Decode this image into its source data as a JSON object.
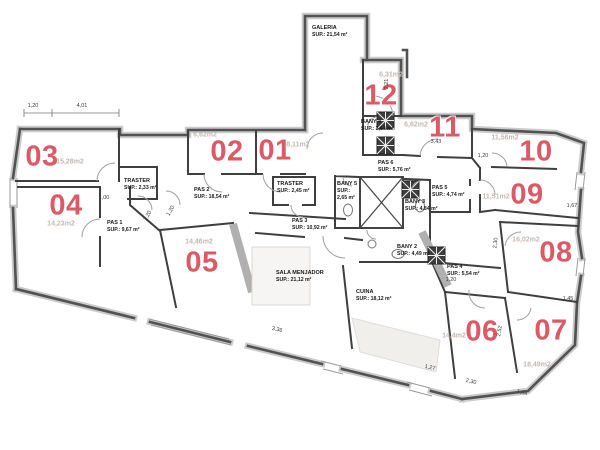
{
  "plan": {
    "rooms": [
      {
        "number": "01",
        "area": "8,11m2"
      },
      {
        "number": "02",
        "area": "6,62m2"
      },
      {
        "number": "03",
        "area": "15,28m2"
      },
      {
        "number": "04",
        "area": "14,23m2"
      },
      {
        "number": "05",
        "area": "14,46m2"
      },
      {
        "number": "06",
        "area": "14,4m2"
      },
      {
        "number": "07",
        "area": "18,49m2"
      },
      {
        "number": "08",
        "area": "16,02m2"
      },
      {
        "number": "09",
        "area": "11,51m2"
      },
      {
        "number": "10",
        "area": "11,56m2"
      },
      {
        "number": "11",
        "area": "6,62m2"
      },
      {
        "number": "12",
        "area": "6,31m2"
      }
    ],
    "spaces": [
      {
        "name": "GALERIA",
        "sup": "SUP.: 21,54 m²"
      },
      {
        "name": "TRASTER",
        "sup": "SUP.: 2,33 m²"
      },
      {
        "name": "TRASTER",
        "sup": "SUP.: 2,45 m²"
      },
      {
        "name": "PAS 1",
        "sup": "SUP.: 9,67 m²"
      },
      {
        "name": "PAS 2",
        "sup": "SUP.: 18,54 m²"
      },
      {
        "name": "PAS 3",
        "sup": "SUP.: 10,92 m²"
      },
      {
        "name": "PAS 4",
        "sup": "SUP.: 5,54 m²"
      },
      {
        "name": "PAS 5",
        "sup": "SUP.: 4,74 m²"
      },
      {
        "name": "PAS 6",
        "sup": "SUP.: 5,76 m²"
      },
      {
        "name": "BANY 2",
        "sup": "SUP.: 4,49 m²"
      },
      {
        "name": "BANY 3",
        "sup": "SUP.: 4,84 m²"
      },
      {
        "name": "BANY 4",
        "sup": "SUP.: 3,64 m²"
      },
      {
        "name": "BANY 5",
        "sup": "SUP.: 2,65 m²"
      },
      {
        "name": "SALA MENJADOR",
        "sup": "SUP.: 21,12 m²"
      },
      {
        "name": "CUINA",
        "sup": "SUP.: 18,12 m²"
      }
    ],
    "dims": [
      "1,20",
      "4,01",
      "1,00",
      "1,20",
      "1,20",
      "2,21",
      "3,43",
      "1,20",
      "1,67",
      "2,30",
      "1,45",
      "1,20",
      "2,52",
      "3,36",
      "1,27",
      "2,30",
      "1,84"
    ]
  },
  "colors": {
    "room_number": "#db5a65",
    "area_label": "#c4b9b4",
    "wall": "#525252",
    "shower_symbol": "#3d3d3d"
  }
}
